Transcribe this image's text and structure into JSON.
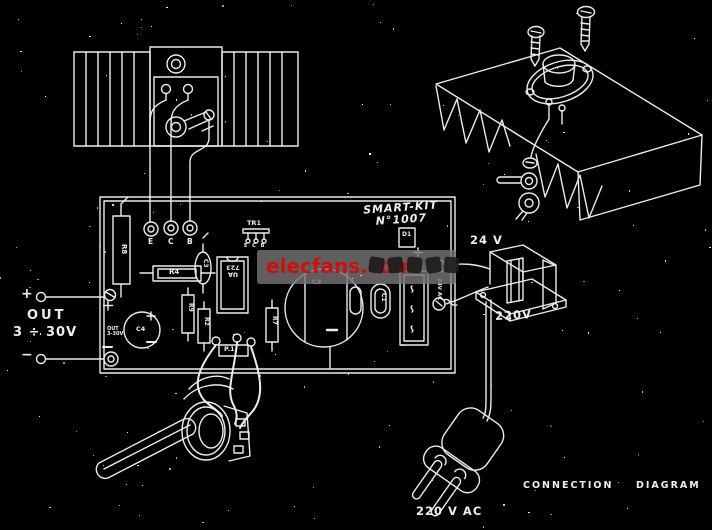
{
  "board_title": {
    "line1": "SMART-KIT",
    "line2": "N°1007"
  },
  "output": {
    "plus": "+",
    "minus": "−",
    "label": "OUT",
    "range": "3 ÷ 30V"
  },
  "transformer": {
    "secondary": "24 V",
    "primary": "220V"
  },
  "captions": {
    "mains": "220 V AC",
    "connection": "CONNECTION",
    "diagram": "DIAGRAM"
  },
  "watermark": {
    "text": "elecfans.com"
  },
  "pcb": {
    "pad_e": "E",
    "pad_c": "C",
    "pad_b": "B",
    "tr1": "TR1",
    "tr1_pins": "E C B",
    "r8": "R8",
    "r4": "R4",
    "r9": "R9",
    "r2": "R2",
    "r7": "R7",
    "c1": "C1",
    "c2": "C2",
    "c3": "C3",
    "c4": "C4",
    "ic_line1": "UA",
    "ic_line2": "723",
    "d1": "D1",
    "d1_plus": "+",
    "p1": "P.1",
    "out_silk_line1": "OUT",
    "out_silk_line2": "3-30V",
    "ac_silk": "24V AC"
  }
}
